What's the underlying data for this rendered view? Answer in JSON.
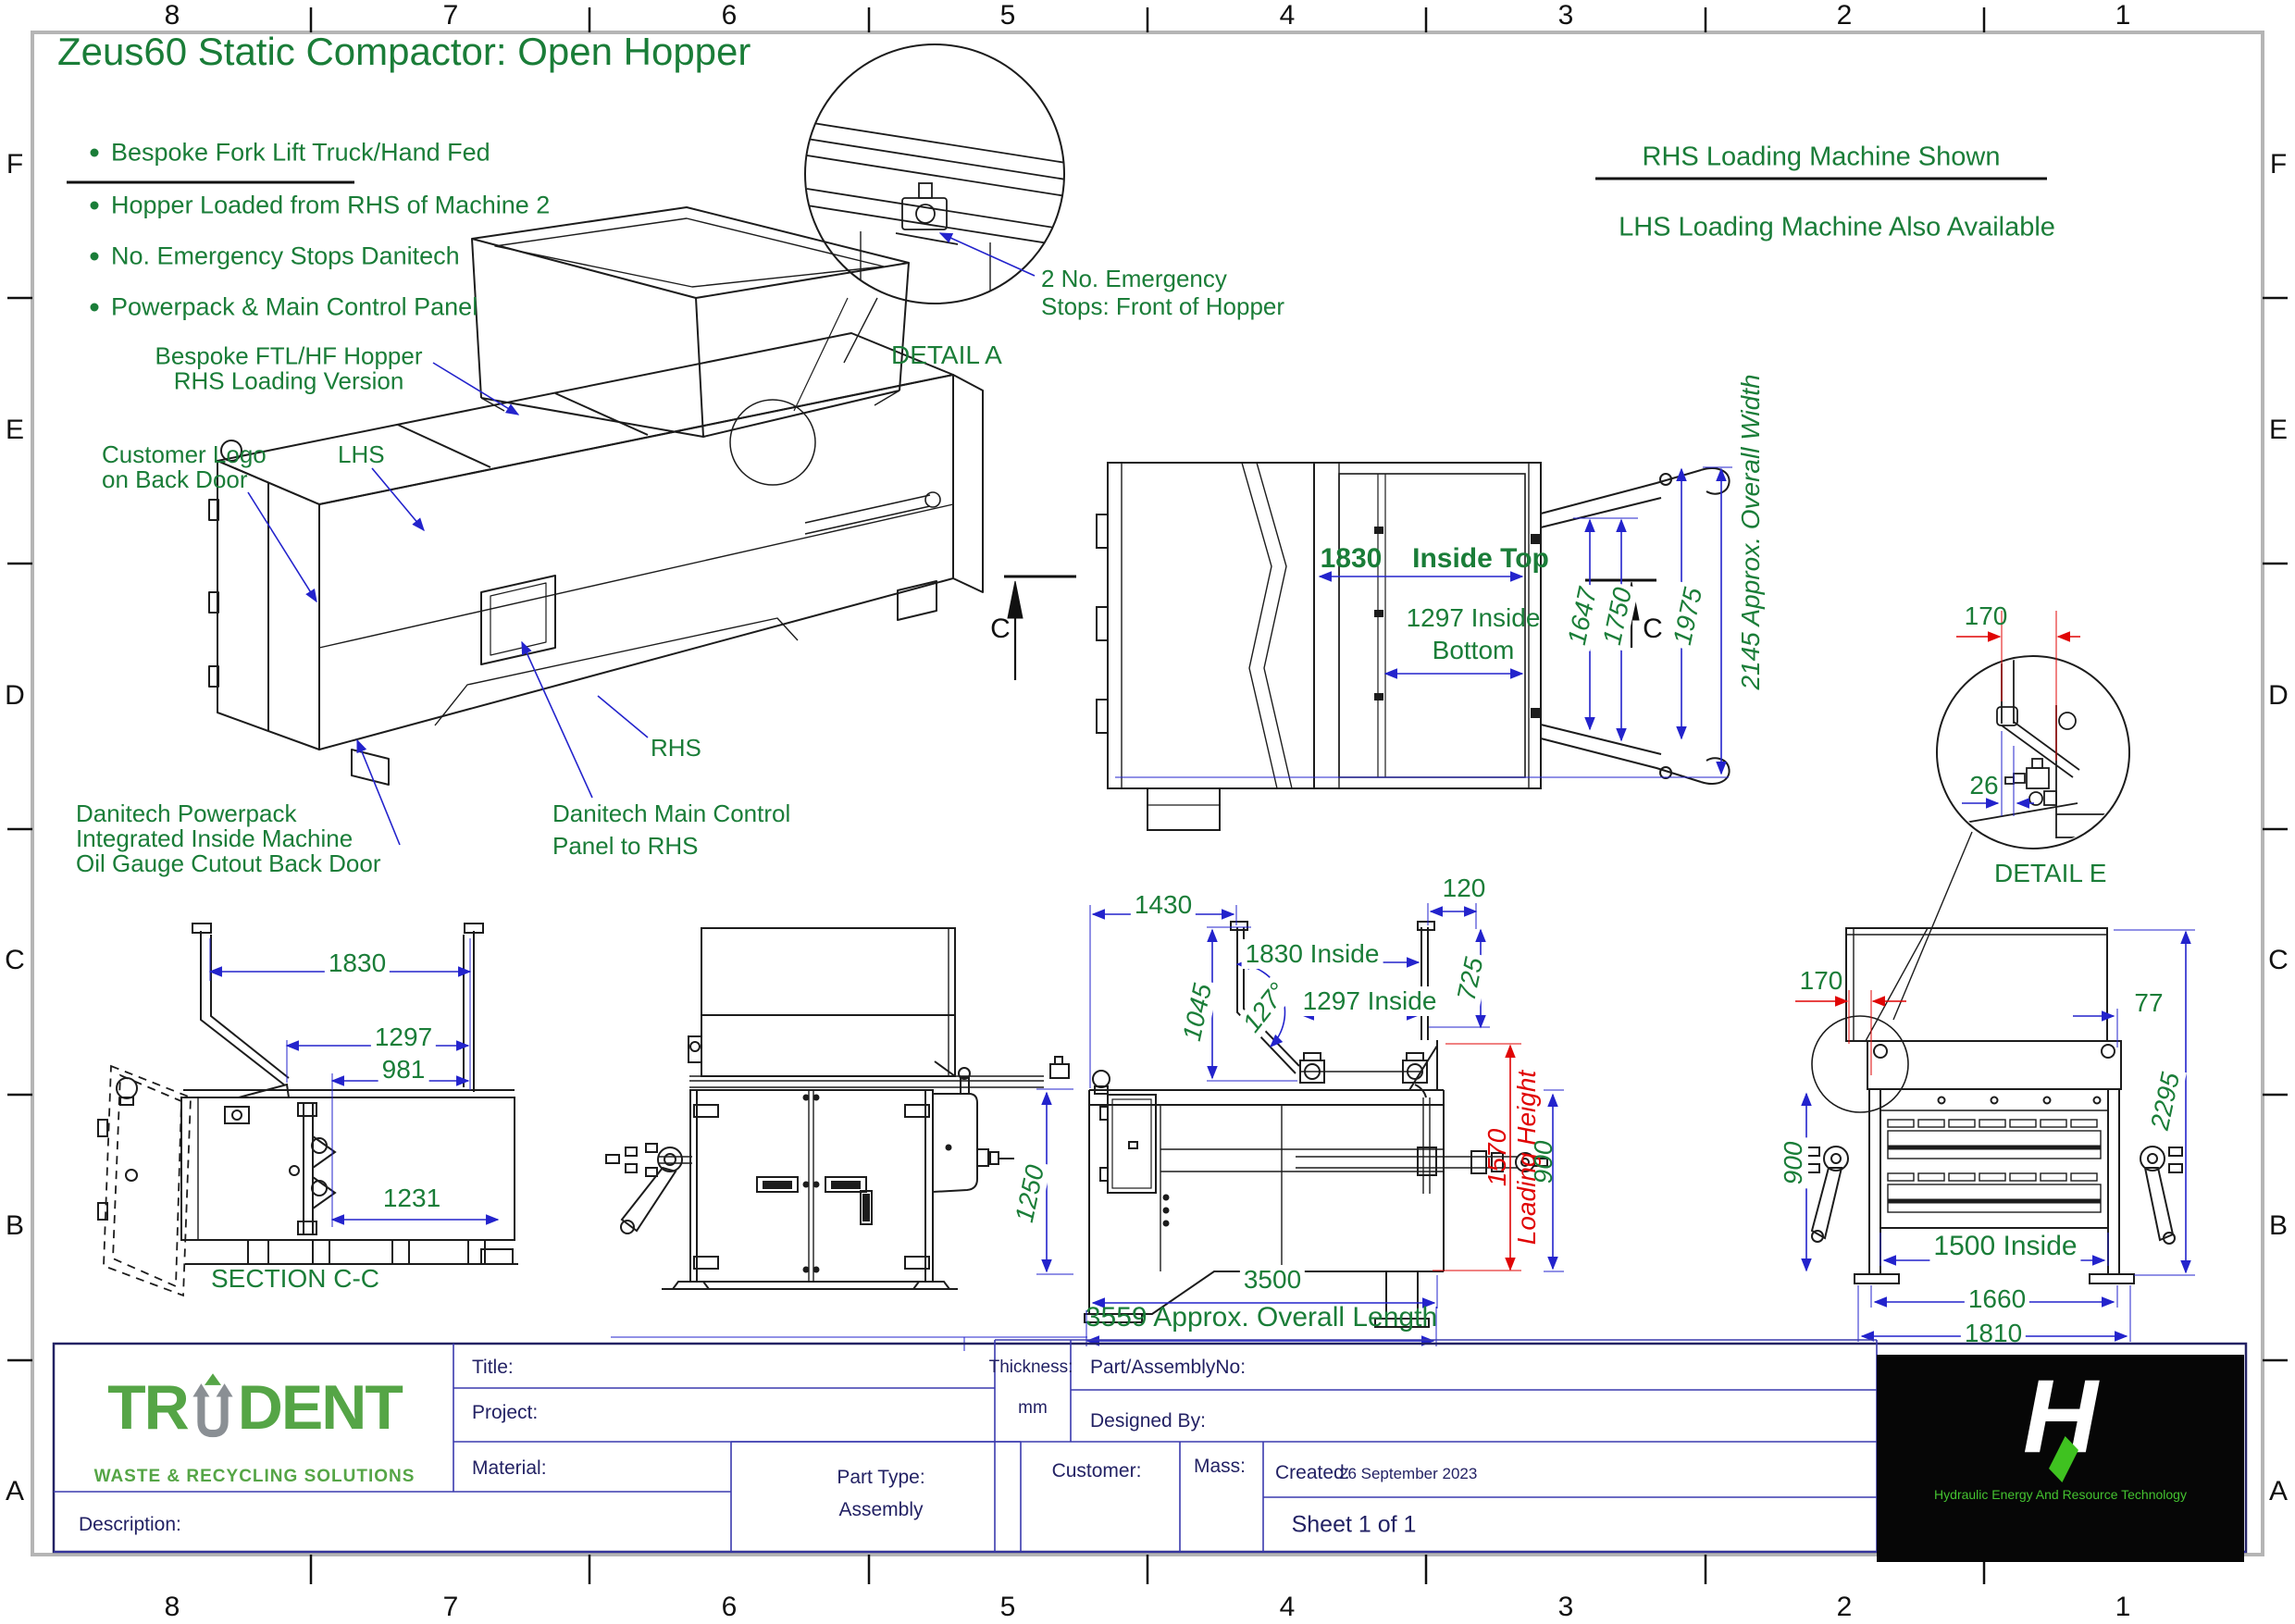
{
  "sheet": {
    "zones": {
      "cols": [
        "8",
        "7",
        "6",
        "5",
        "4",
        "3",
        "2",
        "1"
      ],
      "rows": [
        "F",
        "E",
        "D",
        "C",
        "B",
        "A"
      ]
    }
  },
  "colors": {
    "green": "#1a7d38",
    "blue": "#2323cc",
    "red": "#e00505",
    "navy": "#232264",
    "logo_green": "#55a546",
    "heart_green": "#3fc220"
  },
  "header": {
    "title": "Zeus60 Static Compactor: Open Hopper",
    "bullets": [
      "Bespoke Fork Lift Truck/Hand Fed",
      "Hopper Loaded from RHS of Machine 2",
      "No. Emergency Stops Danitech",
      "Powerpack & Main Control Panel"
    ],
    "note_line1": "RHS Loading Machine Shown",
    "note_line2": "LHS Loading Machine Also Available"
  },
  "annotations": {
    "hopper1": "Bespoke FTL/HF Hopper",
    "hopper2": "RHS Loading Version",
    "cust1": "Customer Logo",
    "cust2": "on Back Door",
    "lhs": "LHS",
    "rhs": "RHS",
    "pp1": "Danitech Powerpack",
    "pp2": "Integrated Inside Machine",
    "pp3": "Oil Gauge Cutout Back Door",
    "mc1": "Danitech Main Control",
    "mc2": "Panel to RHS",
    "es1": "2 No. Emergency",
    "es2": "Stops: Front of Hopper",
    "detail_a": "DETAIL A",
    "detail_e": "DETAIL E",
    "section_cc": "SECTION C-C"
  },
  "dims": {
    "plan": {
      "w1830": "1830",
      "inside_top": "Inside Top",
      "w1297": "1297 Inside",
      "bottom": "Bottom",
      "d1647": "1647",
      "d1750": "1750",
      "d1975": "1975",
      "overall_width": "2145 Approx. Overall Width",
      "c": "C"
    },
    "detail_e": {
      "d170": "170",
      "d26": "26"
    },
    "section": {
      "d1830": "1830",
      "d1297": "1297",
      "d981": "981",
      "d1231": "1231"
    },
    "front": {
      "d1250": "1250"
    },
    "side": {
      "d1430": "1430",
      "d120": "120",
      "d1830": "1830 Inside",
      "d1297": "1297 Inside",
      "d1045": "1045",
      "a127": "127°",
      "d725": "725",
      "d3500": "3500",
      "overall": "3559 Approx. Overall Length",
      "d1570": "1570",
      "loading": "Loading Height",
      "d900": "900"
    },
    "right": {
      "d170": "170",
      "d77": "77",
      "d2295": "2295",
      "d900": "900",
      "d1500": "1500 Inside",
      "d1660": "1660",
      "d1810": "1810"
    }
  },
  "title_block": {
    "title": "Title:",
    "project": "Project:",
    "material": "Material:",
    "description": "Description:",
    "thickness": "Thickness:",
    "thickness_unit": "mm",
    "part_no": "Part/AssemblyNo:",
    "designed_by": "Designed By:",
    "part_type": "Part Type:",
    "part_type_value": "Assembly",
    "customer": "Customer:",
    "mass": "Mass:",
    "created": "Created:",
    "created_value": "26 September 2023",
    "sheet_no": "Sheet 1 of 1"
  },
  "logos": {
    "trident_left": "TR",
    "trident_right": "DENT",
    "trident_tag": "WASTE & RECYCLING SOLUTIONS",
    "heart_letter": "H",
    "heart_tag": "Hydraulic Energy And Resource Technology"
  }
}
